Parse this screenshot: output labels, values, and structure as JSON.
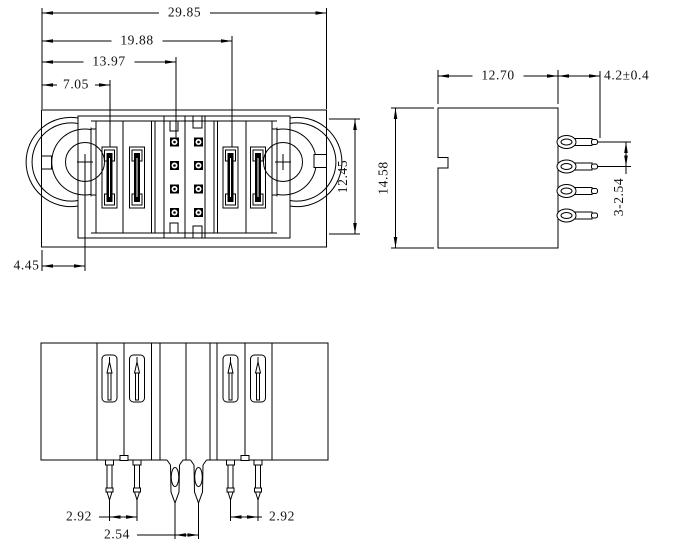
{
  "drawing_title": "connector-3-view-dimension-drawing",
  "style": {
    "background": "#ffffff",
    "line_color": "#000000",
    "text_color": "#111111"
  },
  "dims": {
    "top_view": {
      "overall_width": "29.85",
      "pin_group_width": "19.88",
      "contact_offset": "13.97",
      "first_pin_offset": "7.05",
      "circle_center_offset": "4.45",
      "inner_height": "12.45"
    },
    "side_view": {
      "body_width": "12.70",
      "pin_length": "4.2±0.4",
      "body_height": "14.58",
      "pin_pitch": "3-2.54"
    },
    "bottom_view": {
      "left_pin_spacing": "2.92",
      "center_pin_spacing": "2.54",
      "right_pin_spacing": "2.92"
    }
  }
}
